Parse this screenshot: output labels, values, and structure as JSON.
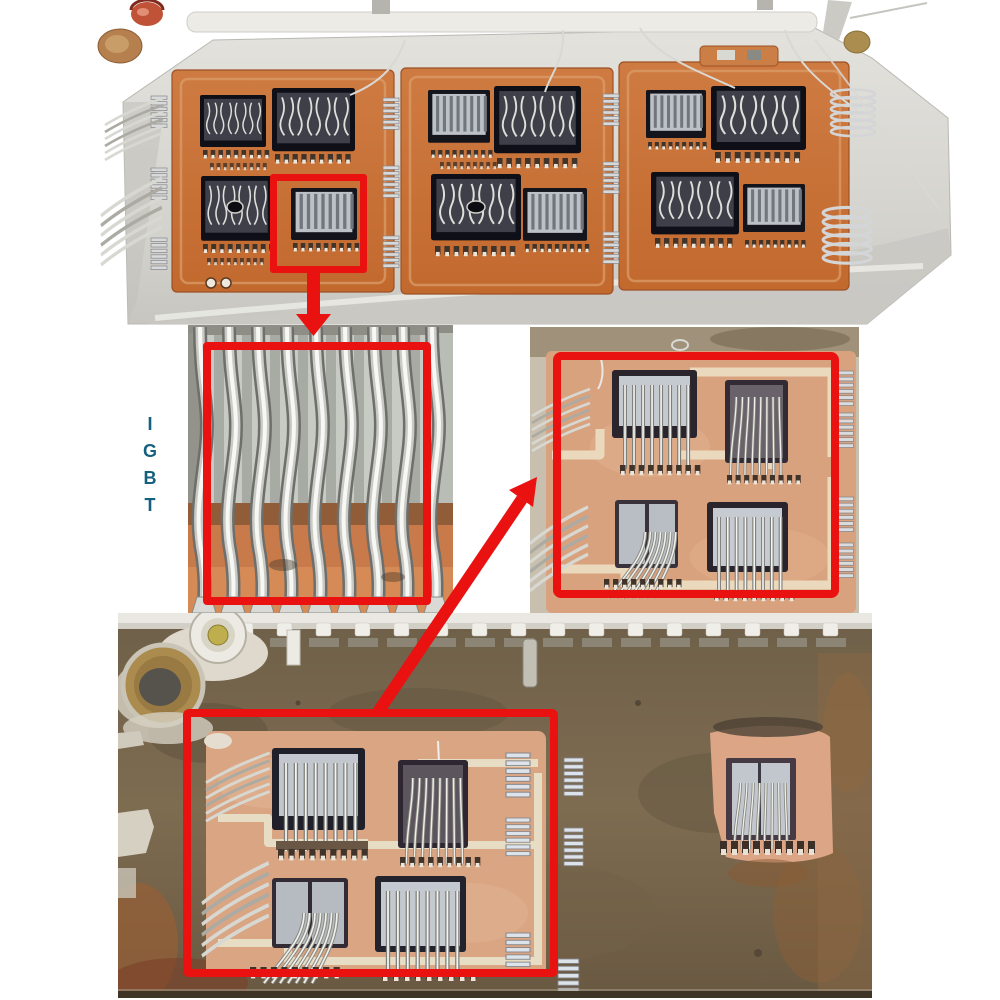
{
  "figure": {
    "background_color": "#ffffff",
    "annotation_color": "#ea1111",
    "label": {
      "text": "IGBT",
      "color": "#16607f"
    },
    "panels": {
      "top": "opened IGBT power module, top view with three orange DBC substrates and wire-bonded chips",
      "middle_left": "close-up of thick aluminium bond wires on chip",
      "middle_right": "close-up of substrate with four wire-bonded chips",
      "bottom": "degraded baseplate with substrate and isolated chip"
    },
    "annotations": {
      "highlight_boxes": 4,
      "arrows": 2
    }
  }
}
